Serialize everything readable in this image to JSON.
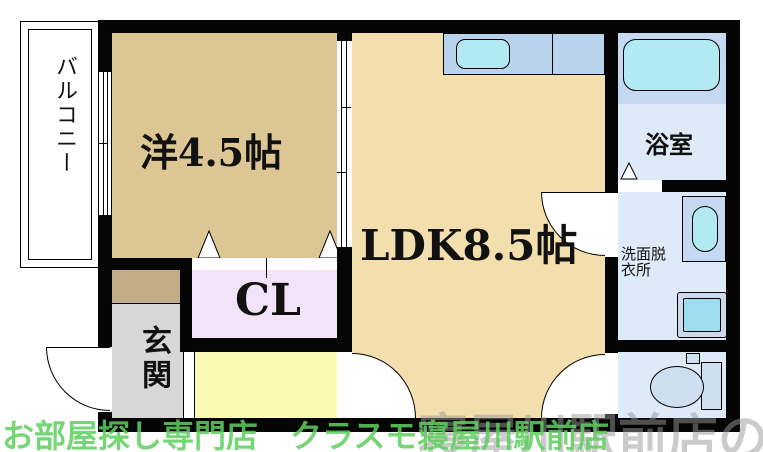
{
  "rooms": {
    "balcony": {
      "label": "バルコニー"
    },
    "western": {
      "label": "洋4.5帖"
    },
    "ldk": {
      "label": "LDK8.5帖"
    },
    "bathroom": {
      "label": "浴室"
    },
    "washroom": {
      "label_line1": "洗面脱",
      "label_line2": "衣所"
    },
    "closet": {
      "label": "CL"
    },
    "entrance": {
      "label": "玄関"
    }
  },
  "watermark": {
    "shop_text": "お部屋探し専門店　クラスモ寝屋川駅前店",
    "logo_text": "寝屋川駅前店のクラスモ"
  },
  "colors": {
    "western_floor": "#dcc693",
    "ldk_floor": "#f2dfad",
    "closet_floor": "#f3e3f8",
    "hallway_floor": "#fafab4",
    "entrance_floor": "#d7d7d7",
    "entrance_step": "#c2ad88",
    "wet_area_floor": "#dfeaf8",
    "counter_blue": "#b9d3ee",
    "fixture_blue": "#c5d9f2",
    "water_cyan": "#b2eaf4",
    "wall_black": "#050505",
    "watermark_green": "#5ecf5e",
    "watermark_gray": "#999999"
  }
}
